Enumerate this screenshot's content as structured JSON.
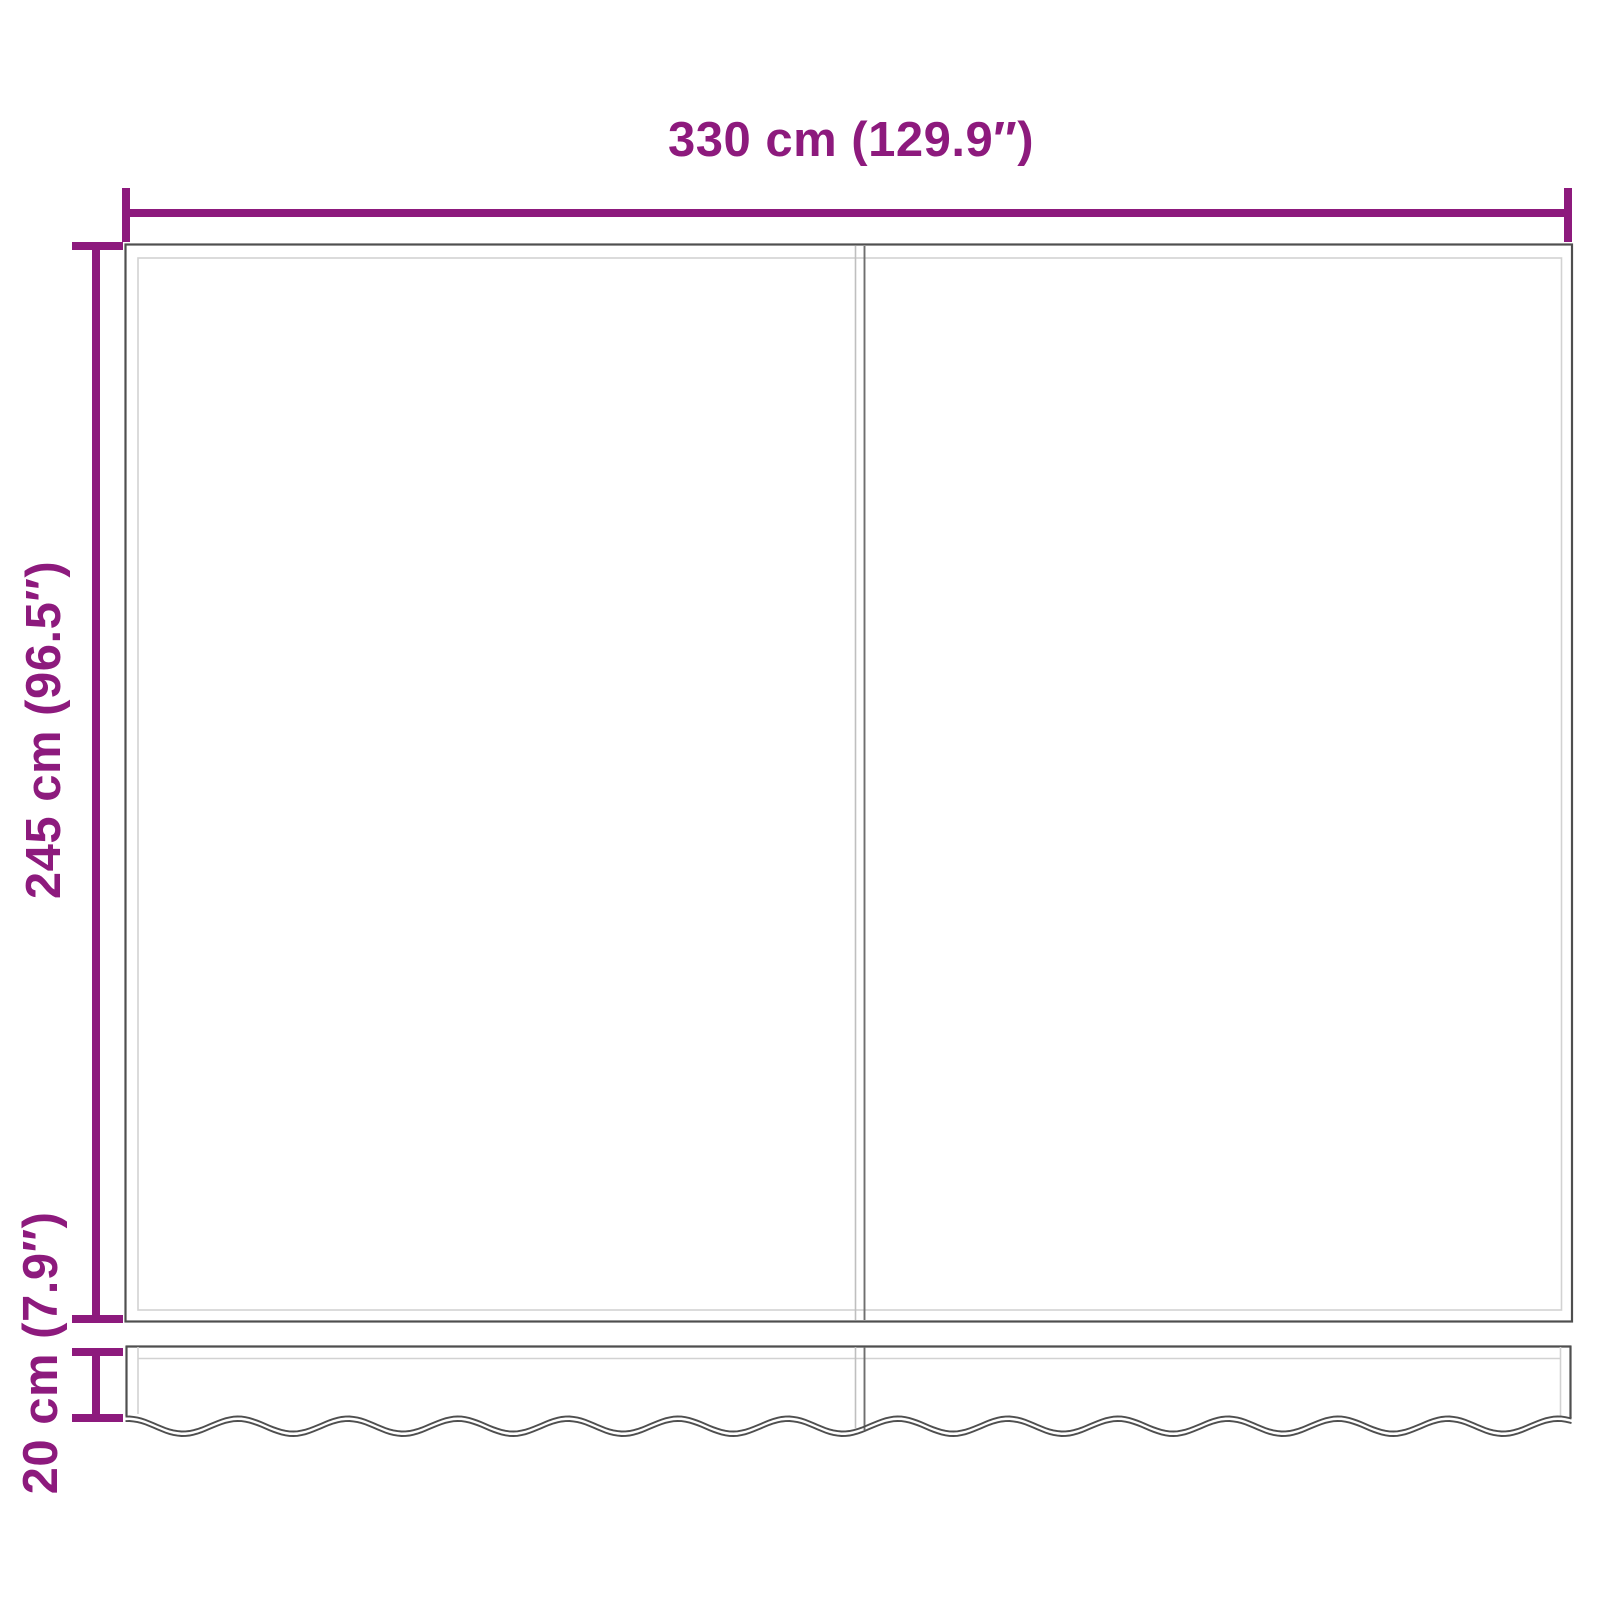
{
  "diagram": {
    "background": "#ffffff",
    "accent_color": "#8d1a7d",
    "outline_color": "#4f4f4f",
    "seam_dark_color": "#6f6f6f",
    "seam_light_color": "#bfbfbf",
    "inner_line_color": "#d2d2d2",
    "labels": {
      "width": "330 cm (129.9″)",
      "height": "245 cm (96.5″)",
      "valance": "20 cm (7.9″)"
    },
    "measurements": {
      "width_cm": 330,
      "width_in": 129.9,
      "height_cm": 245,
      "height_in": 96.5,
      "valance_cm": 20,
      "valance_in": 7.9
    }
  }
}
